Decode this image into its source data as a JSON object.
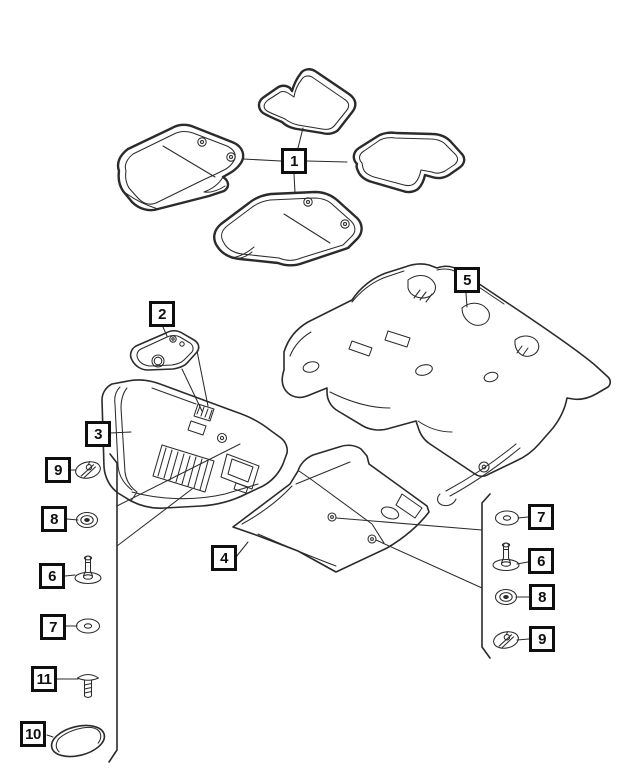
{
  "colors": {
    "background": "#ffffff",
    "line": "#2b2b2b",
    "callout_border": "#0f0f0f",
    "callout_text": "#0f0f0f"
  },
  "callouts": {
    "main": {
      "c1": {
        "label": "1",
        "points_to": "floor-mat-set"
      },
      "c2": {
        "label": "2",
        "points_to": "footrest-pad"
      },
      "c3": {
        "label": "3",
        "points_to": "front-floor-carpet"
      },
      "c4": {
        "label": "4",
        "points_to": "center-floor-carpet"
      },
      "c5": {
        "label": "5",
        "points_to": "rear-floor-carpet"
      }
    },
    "left_column": [
      {
        "label": "9",
        "glyph": "quarter-turn-retainer-icon"
      },
      {
        "label": "8",
        "glyph": "grommet-nut-icon"
      },
      {
        "label": "6",
        "glyph": "push-pin-fastener-icon"
      },
      {
        "label": "7",
        "glyph": "flat-washer-icon"
      },
      {
        "label": "11",
        "glyph": "shoulder-screw-icon"
      },
      {
        "label": "10",
        "glyph": "oval-cover-pad-icon"
      }
    ],
    "right_column": [
      {
        "label": "7",
        "glyph": "flat-washer-icon"
      },
      {
        "label": "6",
        "glyph": "push-pin-fastener-icon"
      },
      {
        "label": "8",
        "glyph": "grommet-nut-icon"
      },
      {
        "label": "9",
        "glyph": "quarter-turn-retainer-icon"
      }
    ]
  }
}
